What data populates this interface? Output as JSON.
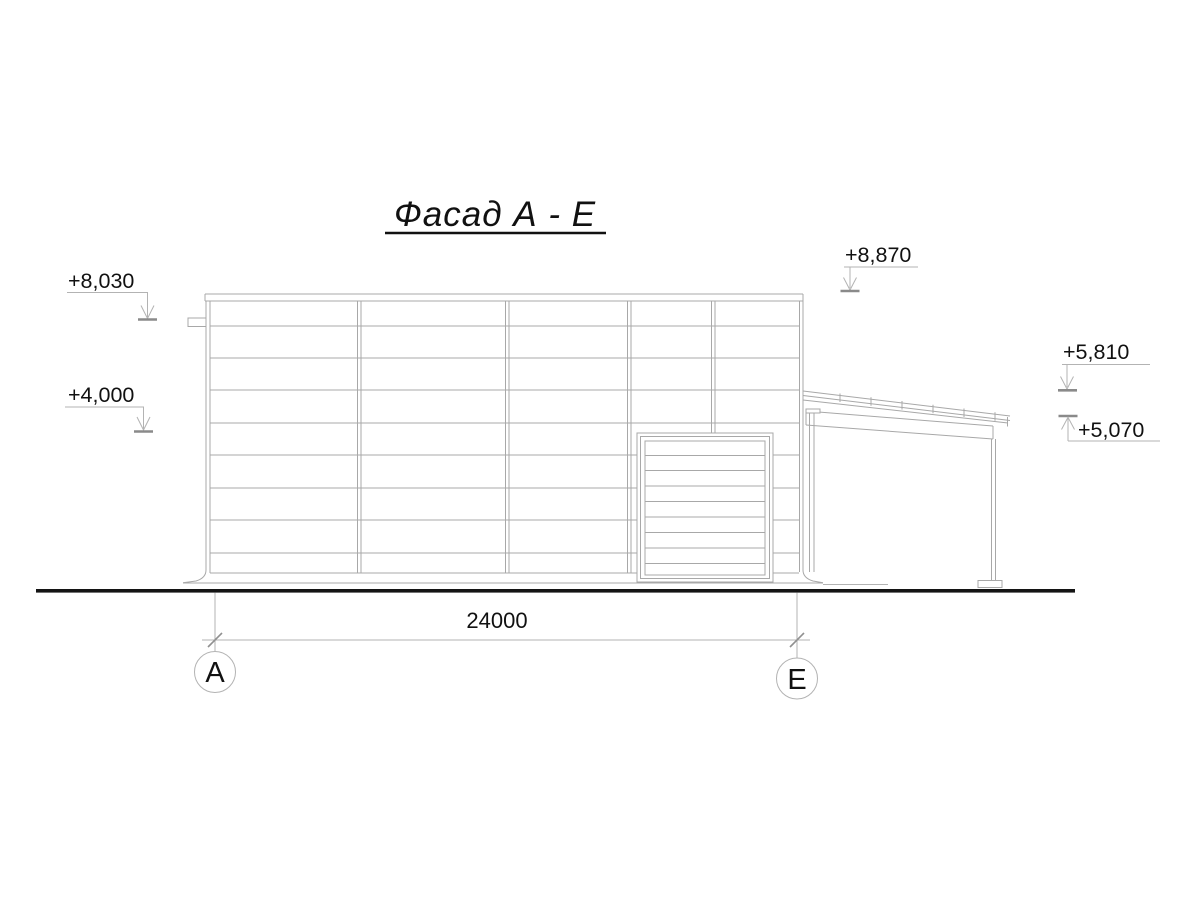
{
  "title": {
    "text": "Фасад А - Е"
  },
  "elevations": {
    "left_parapet": "+8,030",
    "left_mid": "+4,000",
    "right_roof_top": "+8,870",
    "canopy_eave_high": "+5,810",
    "canopy_eave_low": "+5,070"
  },
  "dimension": {
    "span_a_e": "24000"
  },
  "axes": {
    "left": "А",
    "right": "Е"
  },
  "structure": {
    "building": {
      "facade_bays": 5,
      "panel_rows": 9
    },
    "door": {
      "type": "sectional-gate",
      "slats": 9
    },
    "canopy": {
      "posts": 2,
      "roof_seam_ticks": 6,
      "pitch": "down-to-right"
    }
  },
  "colors": {
    "line": "#a8a8a8",
    "marker_tick": "#8a8a8a",
    "ground_line": "#141414",
    "text": "#111111",
    "background": "#ffffff"
  }
}
